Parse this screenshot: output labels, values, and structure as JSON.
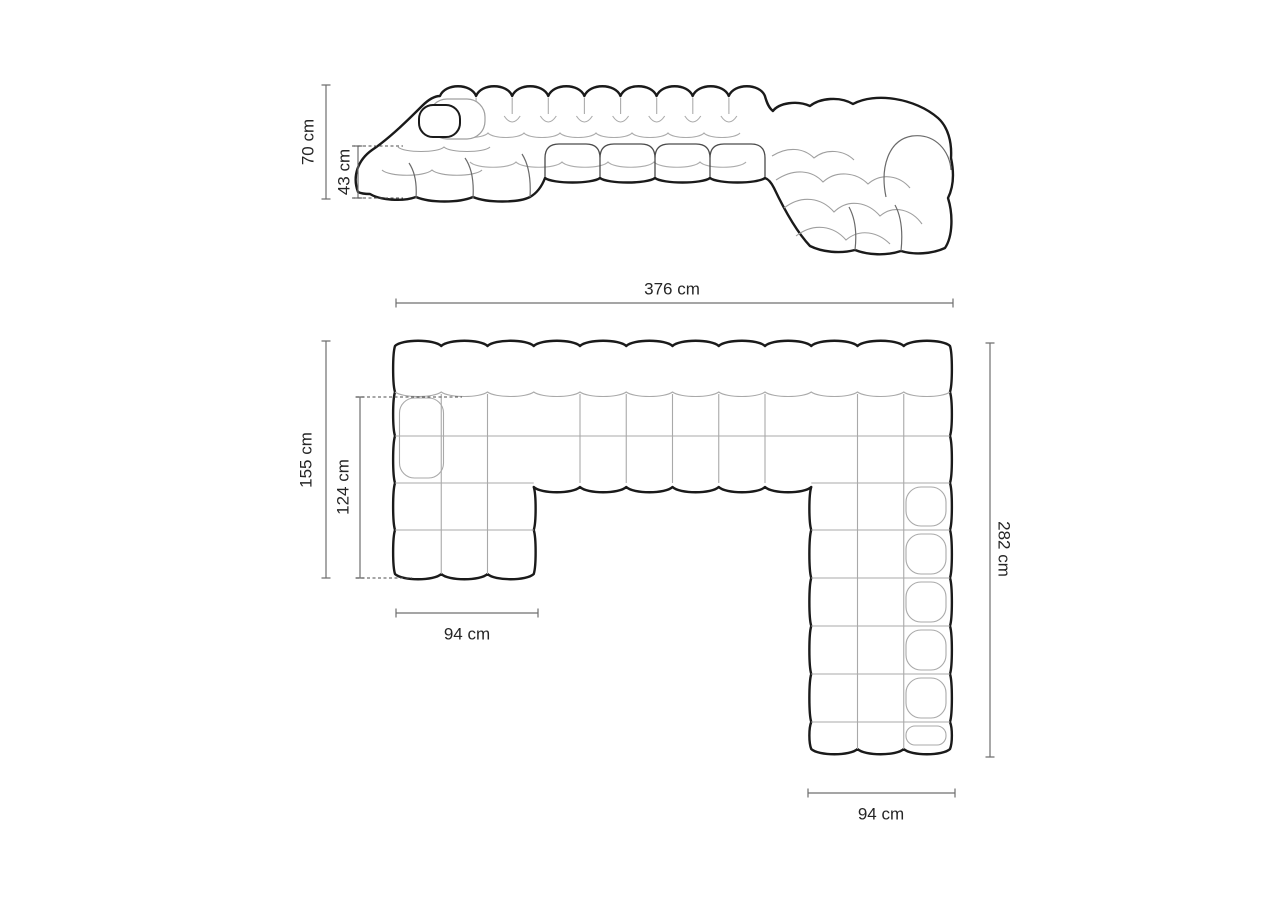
{
  "page": {
    "background": "#ffffff"
  },
  "palette": {
    "outline": "#1a1a1a",
    "tufting_line": "#a9a9a9",
    "dimension_line": "#6f6f6f",
    "label_text": "#262626"
  },
  "front_view": {
    "name": "front-elevation-of-modular-sofa",
    "dimensions": {
      "total_height": "70 cm",
      "seat_height": "43 cm"
    }
  },
  "top_view": {
    "name": "top-plan-of-modular-sofa",
    "dimensions": {
      "total_width": "376 cm",
      "left_depth": "155 cm",
      "left_inner_depth": "124 cm",
      "right_depth": "282 cm",
      "left_chaise_width": "94 cm",
      "right_chaise_width": "94 cm"
    }
  }
}
